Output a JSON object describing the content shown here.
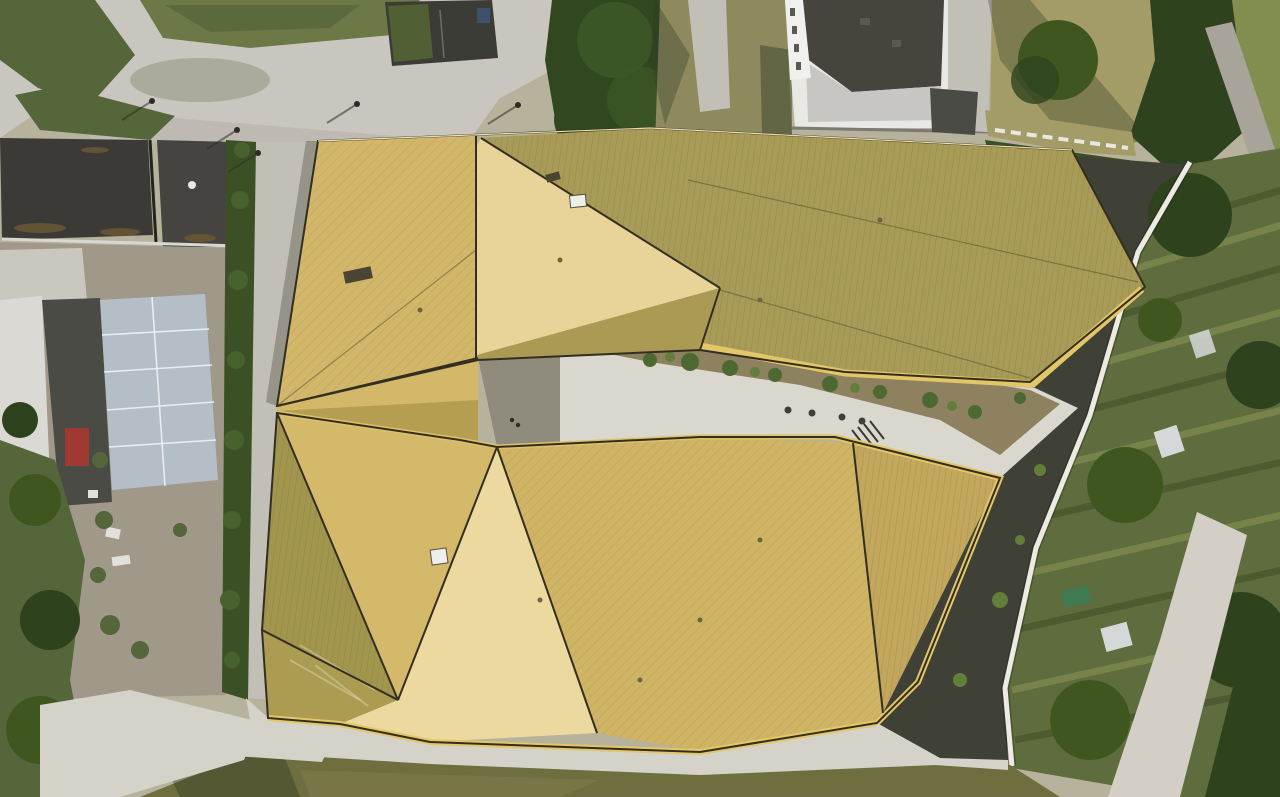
{
  "image_type": "aerial-drone-photograph",
  "scene": {
    "subject": "golden-faceted-roof-building-complex",
    "time_of_day": "low-sun-evening"
  },
  "palette": {
    "plaza": "#c9c6bf",
    "plaza_dim": "#b4b1a9",
    "concrete_path": "#d5d2c9",
    "walkway_bright": "#dad7ce",
    "walkway_shadow": "#8f8b7d",
    "side_path": "#c2bfb6",
    "pit_dark": "#3c3c36",
    "planter_green": "#516034",
    "car_blue": "#3d516e",
    "conifer_dark": "#31471f",
    "conifer_mid": "#3d5627",
    "veg_green": "#55663a",
    "brush_dry": "#6d7847",
    "building_dark_roof": "#3b3a36",
    "building_dark_roof2": "#454441",
    "parapet_white": "#d9d7d1",
    "dirt": "#a0998a",
    "debris_white": "#cac7bf",
    "tarp_white": "#dad9d3",
    "asphalt_dark": "#4b4b45",
    "greenhouse": "#b4bec6",
    "greenhouse_frame": "#e9edf0",
    "red_container": "#9e3a31",
    "red_container2": "#b5453a",
    "hedge": "#3c5026",
    "hedge_light": "#47622d",
    "tree_dark": "#2e431d",
    "tree_mid": "#3f571f",
    "grass_olive": "#6f6e3f",
    "grass_light": "#7c7948",
    "grass_dry": "#a49c66",
    "lawn_olive": "#8f8a5e",
    "soil_dark": "#3f4136",
    "allotment": "#5f6c3d",
    "crop_dark": "#47542c",
    "crop_light": "#828e50",
    "shed_white": "#d5d8d8",
    "tarp_green": "#3f7a52",
    "wall_white": "#eceae3",
    "road": "#a8a49a",
    "wide_path": "#d3cfc6",
    "white_bldg_wall": "#e8e8e5",
    "white_bldg_roof": "#47433d",
    "white_bldg_annex": "#c7c6c2",
    "gold_pale": "#ecd9a0",
    "gold_bright": "#e8d498",
    "gold_medium": "#d4b96b",
    "gold_mid2": "#d0b465",
    "gold_left": "#d2b76a",
    "gold_waist_hi": "#d3b869",
    "gold_waist_lo": "#b59d52",
    "gold_dark": "#a89b57",
    "gold_dark2": "#a2964e",
    "gold_dark3": "#ab9c52",
    "gold_slope": "#ab9a53",
    "gold_facet_r": "#c2a75c",
    "fascia": "#e2c668",
    "fascia2": "#dcc06a",
    "seam": "#332e20",
    "skylight": "#eeeeea",
    "vent_dark": "#4a4435",
    "courtyard": "#ccc9c0",
    "bed_soil": "#8d815f",
    "plant": "#4e6831",
    "plant2": "#617e3a",
    "shadow_tint": "#2e3a24",
    "base_ground": "#b7b29c"
  }
}
